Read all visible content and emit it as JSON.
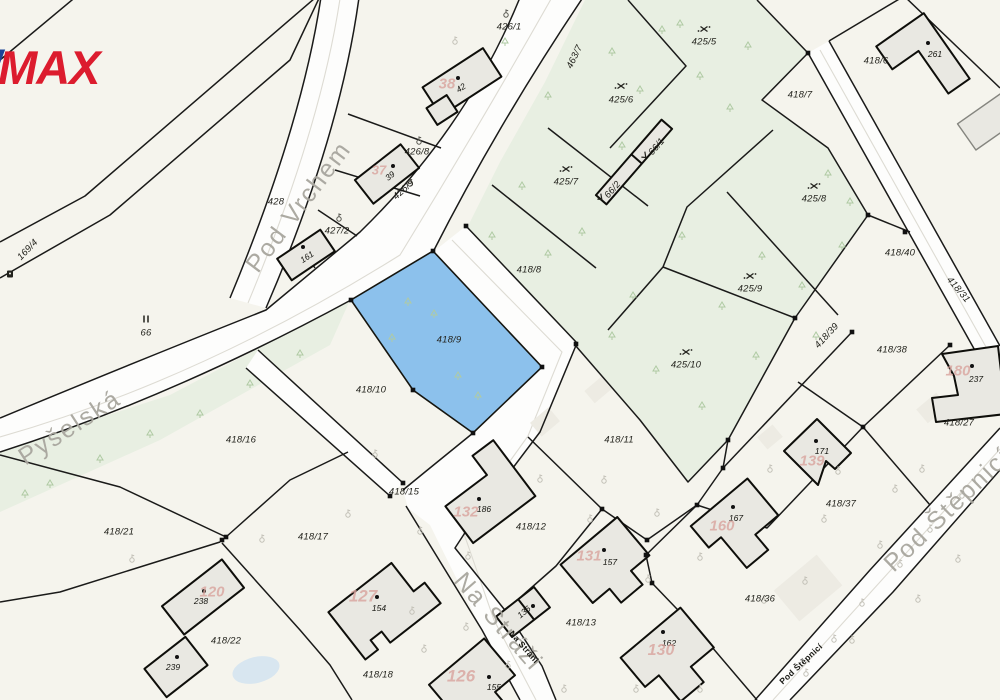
{
  "logo": {
    "slash": "/",
    "text": "MAX",
    "color_red": "#dc1c2e",
    "color_blue": "#1c4498"
  },
  "highlight": {
    "id": "418/9",
    "fill": "#8cc1ec"
  },
  "map": {
    "colors": {
      "background": "#f5f4ed",
      "green": "#e8efe2",
      "road": "#fdfdfc",
      "line": "#1a1a19",
      "building_fill": "#e9e8e2",
      "highlight": "#8cc1ec",
      "house_number": "#d9a49e",
      "street_gray": "#a8a69e",
      "tree": "#afcaa3",
      "pond": "#d8e6f0"
    },
    "labels": [
      {
        "t": "Pod Vrchem",
        "x": 299,
        "y": 207,
        "r": -53,
        "c": "street"
      },
      {
        "t": "Pyšelská",
        "x": 70,
        "y": 428,
        "r": -33,
        "c": "street"
      },
      {
        "t": "Na Stráži",
        "x": 498,
        "y": 622,
        "r": 49,
        "c": "street"
      },
      {
        "t": "Pod Štěpnicí",
        "x": 948,
        "y": 510,
        "r": -44,
        "c": "street"
      },
      {
        "t": "Na Stráni",
        "x": 524,
        "y": 647,
        "r": 49,
        "c": "streetsm"
      },
      {
        "t": "Pod Štěpnicí",
        "x": 801,
        "y": 664,
        "r": -43,
        "c": "streetsm"
      },
      {
        "t": "426/1",
        "x": 509,
        "y": 27,
        "c": "parcel"
      },
      {
        "t": "463/7",
        "x": 575,
        "y": 57,
        "r": -64,
        "c": "parcel"
      },
      {
        "t": "425/5",
        "x": 704,
        "y": 42,
        "c": "parcel"
      },
      {
        "t": "418/6",
        "x": 876,
        "y": 61,
        "c": "parcel"
      },
      {
        "t": "418/7",
        "x": 800,
        "y": 95,
        "c": "parcel"
      },
      {
        "t": "425/6",
        "x": 621,
        "y": 100,
        "c": "parcel"
      },
      {
        "t": "426/8",
        "x": 417,
        "y": 152,
        "c": "parcel"
      },
      {
        "t": "66/1",
        "x": 657,
        "y": 147,
        "r": -49,
        "c": "parcel"
      },
      {
        "t": "66/2",
        "x": 613,
        "y": 190,
        "r": -49,
        "c": "parcel"
      },
      {
        "t": "425/7",
        "x": 566,
        "y": 182,
        "c": "parcel"
      },
      {
        "t": "428",
        "x": 276,
        "y": 202,
        "c": "parcel"
      },
      {
        "t": "426/9",
        "x": 404,
        "y": 190,
        "r": -42,
        "c": "parcel"
      },
      {
        "t": "427/2",
        "x": 337,
        "y": 231,
        "c": "parcel"
      },
      {
        "t": "425/8",
        "x": 814,
        "y": 199,
        "c": "parcel"
      },
      {
        "t": "169/4",
        "x": 28,
        "y": 250,
        "r": -46,
        "c": "parcel"
      },
      {
        "t": "418/40",
        "x": 900,
        "y": 253,
        "c": "parcel"
      },
      {
        "t": "418/8",
        "x": 529,
        "y": 270,
        "c": "parcel"
      },
      {
        "t": "425/9",
        "x": 750,
        "y": 289,
        "c": "parcel"
      },
      {
        "t": "418/31",
        "x": 958,
        "y": 290,
        "r": 50,
        "c": "parcel"
      },
      {
        "t": "66",
        "x": 146,
        "y": 333,
        "c": "parcel"
      },
      {
        "t": "418/9",
        "x": 449,
        "y": 340,
        "c": "parcel"
      },
      {
        "t": "418/39",
        "x": 827,
        "y": 336,
        "r": -47,
        "c": "parcel"
      },
      {
        "t": "418/38",
        "x": 892,
        "y": 350,
        "c": "parcel"
      },
      {
        "t": "425/10",
        "x": 686,
        "y": 365,
        "c": "parcel"
      },
      {
        "t": "418/10",
        "x": 371,
        "y": 390,
        "c": "parcel"
      },
      {
        "t": "418/16",
        "x": 241,
        "y": 440,
        "c": "parcel"
      },
      {
        "t": "418/11",
        "x": 619,
        "y": 440,
        "c": "parcel"
      },
      {
        "t": "418/27",
        "x": 959,
        "y": 423,
        "c": "parcel"
      },
      {
        "t": "418/15",
        "x": 404,
        "y": 492,
        "c": "parcel"
      },
      {
        "t": "418/12",
        "x": 531,
        "y": 527,
        "c": "parcel"
      },
      {
        "t": "418/37",
        "x": 841,
        "y": 504,
        "c": "parcel"
      },
      {
        "t": "418/21",
        "x": 119,
        "y": 532,
        "c": "parcel"
      },
      {
        "t": "418/17",
        "x": 313,
        "y": 537,
        "c": "parcel"
      },
      {
        "t": "418/36",
        "x": 760,
        "y": 599,
        "c": "parcel"
      },
      {
        "t": "418/13",
        "x": 581,
        "y": 623,
        "c": "parcel"
      },
      {
        "t": "418/22",
        "x": 226,
        "y": 641,
        "c": "parcel"
      },
      {
        "t": "418/18",
        "x": 378,
        "y": 675,
        "c": "parcel"
      },
      {
        "t": "42",
        "x": 461,
        "y": 88,
        "r": -33,
        "c": "bldg"
      },
      {
        "t": "39",
        "x": 390,
        "y": 176,
        "r": -38,
        "c": "bldg"
      },
      {
        "t": "161",
        "x": 307,
        "y": 257,
        "r": -34,
        "c": "bldg"
      },
      {
        "t": "261",
        "x": 935,
        "y": 54,
        "c": "bldg"
      },
      {
        "t": "237",
        "x": 976,
        "y": 379,
        "c": "bldg"
      },
      {
        "t": "171",
        "x": 822,
        "y": 451,
        "c": "bldg"
      },
      {
        "t": "167",
        "x": 736,
        "y": 518,
        "c": "bldg"
      },
      {
        "t": "186",
        "x": 484,
        "y": 509,
        "c": "bldg"
      },
      {
        "t": "157",
        "x": 610,
        "y": 562,
        "c": "bldg"
      },
      {
        "t": "238",
        "x": 201,
        "y": 601,
        "c": "bldg"
      },
      {
        "t": "239",
        "x": 173,
        "y": 667,
        "c": "bldg"
      },
      {
        "t": "154",
        "x": 379,
        "y": 608,
        "c": "bldg"
      },
      {
        "t": "136",
        "x": 524,
        "y": 612,
        "r": -40,
        "c": "bldg"
      },
      {
        "t": "162",
        "x": 669,
        "y": 643,
        "c": "bldg"
      },
      {
        "t": "155",
        "x": 494,
        "y": 687,
        "c": "bldg"
      },
      {
        "t": "38",
        "x": 447,
        "y": 84,
        "s": 15,
        "c": "red"
      },
      {
        "t": "37",
        "x": 379,
        "y": 170,
        "s": 13,
        "c": "red"
      },
      {
        "t": "180",
        "x": 958,
        "y": 371,
        "s": 15,
        "c": "red"
      },
      {
        "t": "139",
        "x": 812,
        "y": 461,
        "s": 15,
        "c": "red"
      },
      {
        "t": "160",
        "x": 722,
        "y": 526,
        "s": 15,
        "c": "red"
      },
      {
        "t": "132",
        "x": 466,
        "y": 512,
        "s": 15,
        "c": "red"
      },
      {
        "t": "131",
        "x": 589,
        "y": 556,
        "s": 15,
        "c": "red"
      },
      {
        "t": "120",
        "x": 212,
        "y": 592,
        "s": 15,
        "c": "red"
      },
      {
        "t": "127",
        "x": 363,
        "y": 596,
        "s": 17,
        "c": "red"
      },
      {
        "t": "126",
        "x": 461,
        "y": 676,
        "s": 17,
        "c": "red"
      },
      {
        "t": "130",
        "x": 661,
        "y": 651,
        "s": 16,
        "c": "red"
      }
    ],
    "symbols": {
      "scrub": [
        [
          704,
          29
        ],
        [
          621,
          86
        ],
        [
          566,
          169
        ],
        [
          814,
          186
        ],
        [
          750,
          276
        ],
        [
          686,
          352
        ]
      ],
      "check": [
        [
          645,
          156
        ],
        [
          601,
          198
        ]
      ],
      "garden_dark": [
        [
          506,
          15
        ],
        [
          419,
          142
        ],
        [
          410,
          184
        ],
        [
          339,
          219
        ]
      ],
      "garden_faint": [
        [
          455,
          42
        ],
        [
          375,
          455
        ],
        [
          348,
          515
        ],
        [
          420,
          532
        ],
        [
          468,
          557
        ],
        [
          540,
          480
        ],
        [
          604,
          481
        ],
        [
          657,
          514
        ],
        [
          700,
          558
        ],
        [
          770,
          470
        ],
        [
          838,
          472
        ],
        [
          880,
          546
        ],
        [
          922,
          470
        ],
        [
          648,
          580
        ],
        [
          700,
          690
        ],
        [
          805,
          582
        ],
        [
          852,
          641
        ],
        [
          918,
          600
        ],
        [
          958,
          560
        ],
        [
          424,
          650
        ],
        [
          262,
          540
        ],
        [
          132,
          560
        ],
        [
          895,
          490
        ],
        [
          962,
          496
        ],
        [
          824,
          520
        ],
        [
          764,
          601
        ],
        [
          636,
          690
        ],
        [
          564,
          690
        ],
        [
          466,
          628
        ],
        [
          508,
          666
        ],
        [
          412,
          612
        ],
        [
          590,
          520
        ],
        [
          930,
          530
        ],
        [
          900,
          565
        ],
        [
          862,
          604
        ],
        [
          834,
          640
        ],
        [
          806,
          674
        ]
      ],
      "meadow": [
        [
          146,
          319
        ]
      ],
      "well": [
        [
          10,
          274
        ]
      ],
      "trees": [
        [
          505,
          38
        ],
        [
          548,
          92
        ],
        [
          612,
          48
        ],
        [
          662,
          26
        ],
        [
          700,
          72
        ],
        [
          748,
          42
        ],
        [
          640,
          86
        ],
        [
          680,
          20
        ],
        [
          730,
          104
        ],
        [
          622,
          142
        ],
        [
          582,
          228
        ],
        [
          522,
          182
        ],
        [
          633,
          292
        ],
        [
          682,
          232
        ],
        [
          722,
          302
        ],
        [
          762,
          252
        ],
        [
          802,
          282
        ],
        [
          842,
          242
        ],
        [
          816,
          332
        ],
        [
          756,
          352
        ],
        [
          702,
          402
        ],
        [
          656,
          366
        ],
        [
          612,
          332
        ],
        [
          548,
          250
        ],
        [
          492,
          232
        ],
        [
          850,
          198
        ],
        [
          828,
          170
        ],
        [
          408,
          298
        ],
        [
          434,
          310
        ],
        [
          392,
          334
        ],
        [
          458,
          372
        ],
        [
          478,
          392
        ],
        [
          300,
          350
        ],
        [
          250,
          380
        ],
        [
          200,
          410
        ],
        [
          150,
          430
        ],
        [
          100,
          455
        ],
        [
          50,
          480
        ],
        [
          25,
          490
        ]
      ]
    }
  }
}
